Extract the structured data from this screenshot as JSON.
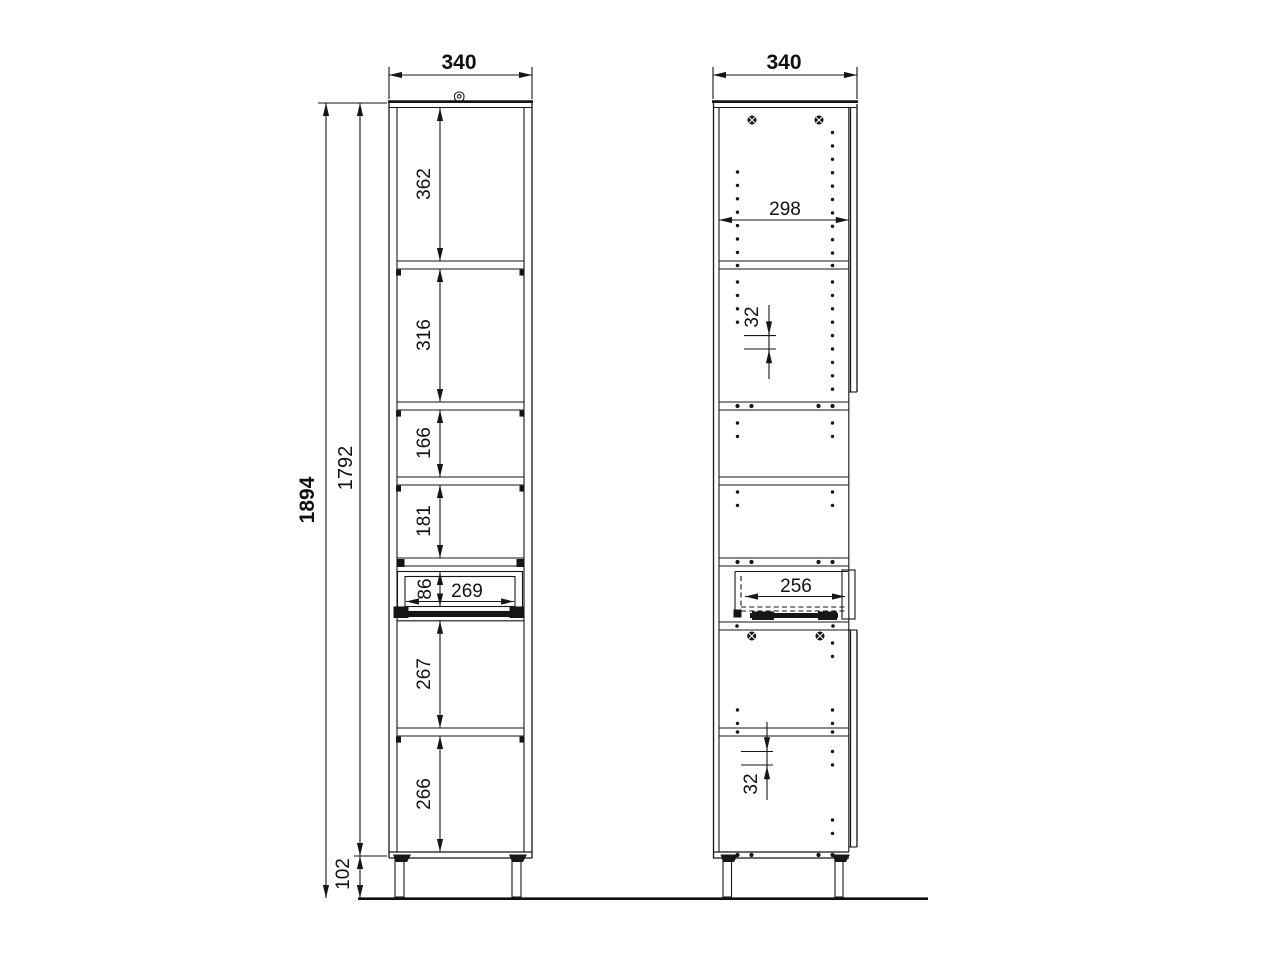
{
  "drawing": {
    "kind": "cabinet technical drawing, two views",
    "front_view": {
      "width_mm": "340",
      "total_height_mm": "1894",
      "carcass_height_mm": "1792",
      "plinth_height_mm": "102",
      "compartments_mm": [
        "362",
        "316",
        "166",
        "181",
        "86",
        "267",
        "266"
      ],
      "drawer_inner_width_mm": "269"
    },
    "side_view": {
      "width_mm": "340",
      "inner_depth_mm": "298",
      "hole_pitch_top_mm": "32",
      "hole_pitch_bottom_mm": "32",
      "drawer_inner_depth_mm": "256"
    },
    "colors": {
      "line": "#161616",
      "background": "#ffffff"
    }
  }
}
